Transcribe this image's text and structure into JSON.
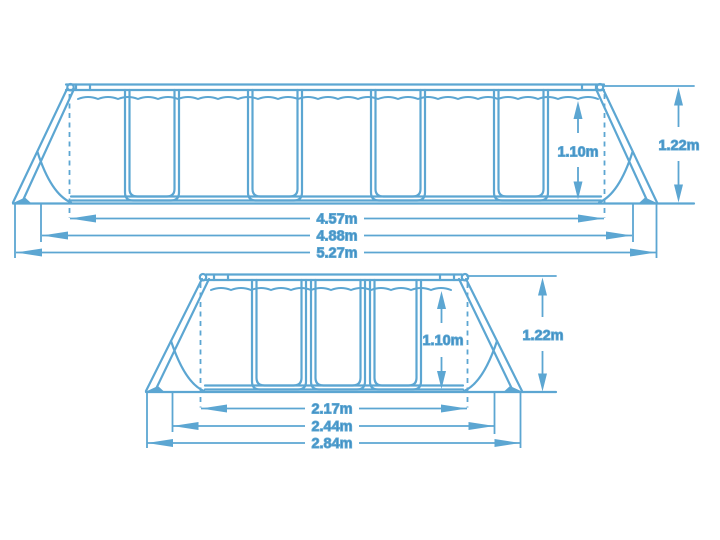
{
  "title": "Frame pool dimension diagram",
  "colors": {
    "line": "#5CA6D2",
    "label": "#3E8CC1",
    "background": "#FFFFFF"
  },
  "top_view": {
    "name": "long side elevation",
    "inner_width": "4.57m",
    "base_width": "4.88m",
    "total_width": "5.27m",
    "water_height": "1.10m",
    "total_height": "1.22m"
  },
  "bottom_view": {
    "name": "short side elevation",
    "inner_width": "2.17m",
    "base_width": "2.44m",
    "total_width": "2.84m",
    "water_height": "1.10m",
    "total_height": "1.22m"
  }
}
